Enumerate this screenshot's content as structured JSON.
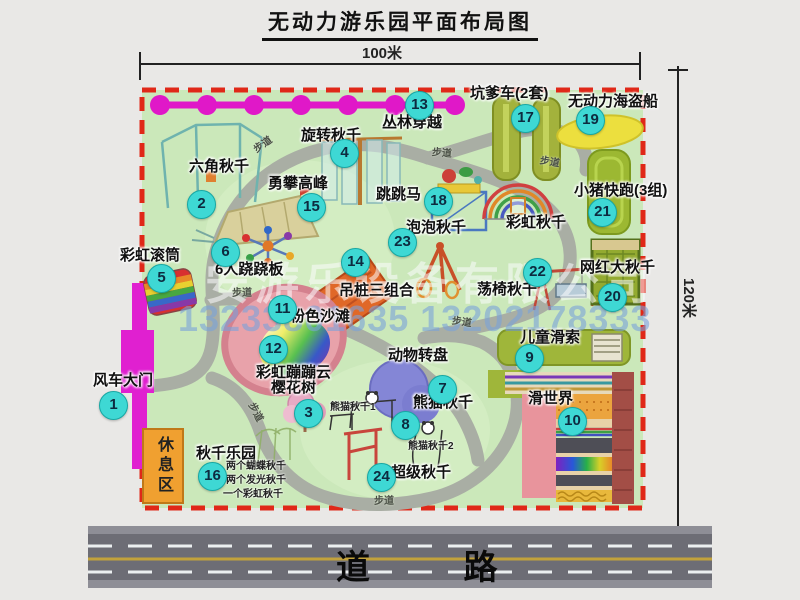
{
  "title": "无动力游乐园平面布局图",
  "dimensions": {
    "width": "100米",
    "height": "120米"
  },
  "road": {
    "label": "道  路"
  },
  "rest_area": {
    "label": "休息区"
  },
  "footpath_label": "步道",
  "watermark": {
    "company": "安游乐设备有限公司",
    "phone": "13233801635 13202178333"
  },
  "rainbow_swing_label": "彩虹秋千",
  "panda_swing_sub1": "熊猫秋千1",
  "panda_swing_sub2": "熊猫秋千2",
  "swing_park_notes": [
    "两个蝴蝶秋千",
    "两个发光秋千",
    "一个彩虹秋千"
  ],
  "colors": {
    "map_bg": "#cbe8ba",
    "border_red": "#e02818",
    "badge_cyan": "#3ed8d4",
    "path_gray": "#a9aea4",
    "gate_magenta": "#e020d0",
    "road_gray": "#6d6d75"
  },
  "items": [
    {
      "num": "1",
      "name": "风车大门"
    },
    {
      "num": "2",
      "name": "六角秋千"
    },
    {
      "num": "3",
      "name": "樱花树"
    },
    {
      "num": "4",
      "name": "旋转秋千"
    },
    {
      "num": "5",
      "name": "彩虹滚筒"
    },
    {
      "num": "6",
      "name": "6人跷跷板"
    },
    {
      "num": "7",
      "name": "动物转盘"
    },
    {
      "num": "8",
      "name": "熊猫秋千"
    },
    {
      "num": "9",
      "name": "儿童滑索"
    },
    {
      "num": "10",
      "name": "滑世界"
    },
    {
      "num": "11",
      "name": "粉色沙滩"
    },
    {
      "num": "12",
      "name": "彩虹蹦蹦云"
    },
    {
      "num": "13",
      "name": "丛林穿越"
    },
    {
      "num": "14",
      "name": "吊桩三组合"
    },
    {
      "num": "15",
      "name": "勇攀高峰"
    },
    {
      "num": "16",
      "name": "秋千乐园"
    },
    {
      "num": "17",
      "name": "坑爹车(2套)"
    },
    {
      "num": "18",
      "name": "跳跳马"
    },
    {
      "num": "19",
      "name": "无动力海盗船"
    },
    {
      "num": "20",
      "name": "网红大秋千"
    },
    {
      "num": "21",
      "name": "小猪快跑(3组)"
    },
    {
      "num": "22",
      "name": "荡椅秋千"
    },
    {
      "num": "23",
      "name": "泡泡秋千"
    },
    {
      "num": "24",
      "name": "超级秋千"
    }
  ]
}
